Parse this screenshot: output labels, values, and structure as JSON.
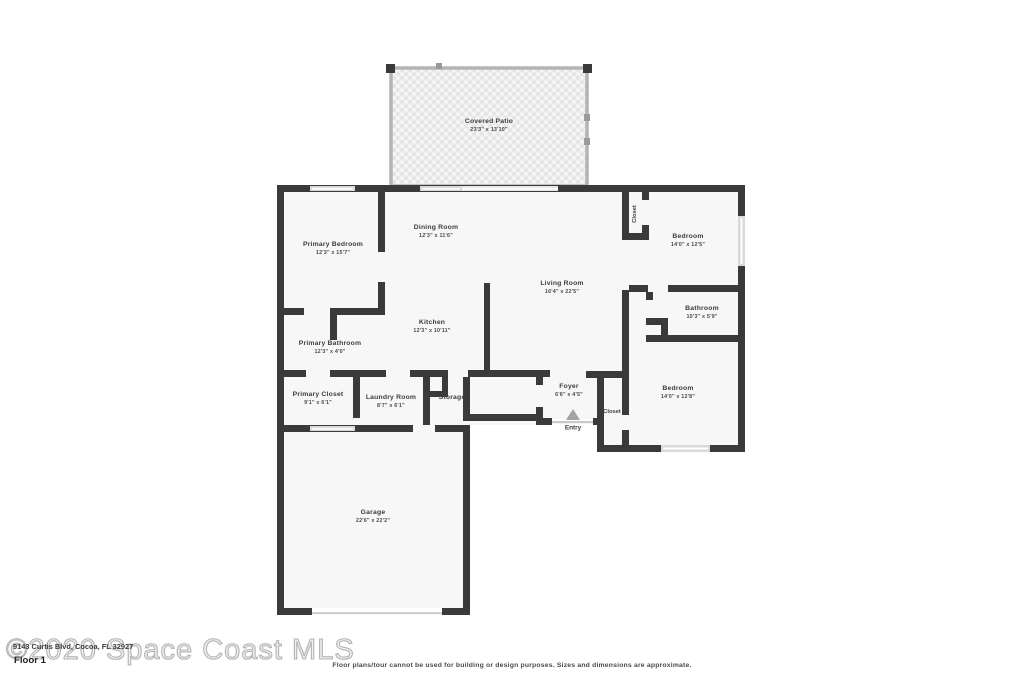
{
  "meta": {
    "watermark": "©2020 Space Coast MLS",
    "address": "9143 Curtis Blvd, Cocoa, FL 32927",
    "floor_label": "Floor 1",
    "disclaimer": "Floor plans/tour cannot be used for building or design purposes. Sizes and dimensions are approximate."
  },
  "colors": {
    "wall": "#3a3a3a",
    "floor": "#f7f7f7",
    "window": "#d9d9d9",
    "patio_frame": "#b4b4b4",
    "entry_arrow": "#a3a3a3"
  },
  "rooms": {
    "covered_patio": {
      "name": "Covered Patio",
      "dims": "23'3\" x 13'10\""
    },
    "primary_bedroom": {
      "name": "Primary Bedroom",
      "dims": "12'3\" x 15'7\""
    },
    "dining_room": {
      "name": "Dining Room",
      "dims": "12'3\" x 11'6\""
    },
    "living_room": {
      "name": "Living Room",
      "dims": "16'4\" x 22'5\""
    },
    "kitchen": {
      "name": "Kitchen",
      "dims": "12'3\" x 10'11\""
    },
    "primary_bathroom": {
      "name": "Primary Bathroom",
      "dims": "12'3\" x 4'0\""
    },
    "primary_closet": {
      "name": "Primary Closet",
      "dims": "9'1\" x 6'1\""
    },
    "laundry_room": {
      "name": "Laundry Room",
      "dims": "8'7\" x 6'1\""
    },
    "storage": {
      "name": "Storage",
      "dims": ""
    },
    "bedroom_top": {
      "name": "Bedroom",
      "dims": "14'0\" x 12'5\""
    },
    "bathroom": {
      "name": "Bathroom",
      "dims": "10'3\" x 5'9\""
    },
    "bedroom_bottom": {
      "name": "Bedroom",
      "dims": "14'0\" x 12'8\""
    },
    "foyer": {
      "name": "Foyer",
      "dims": "6'6\" x 4'5\""
    },
    "garage": {
      "name": "Garage",
      "dims": "22'6\" x 22'2\""
    }
  },
  "labels": {
    "closet_top": "Closet",
    "closet_bottom": "Closet",
    "entry": "Entry"
  }
}
